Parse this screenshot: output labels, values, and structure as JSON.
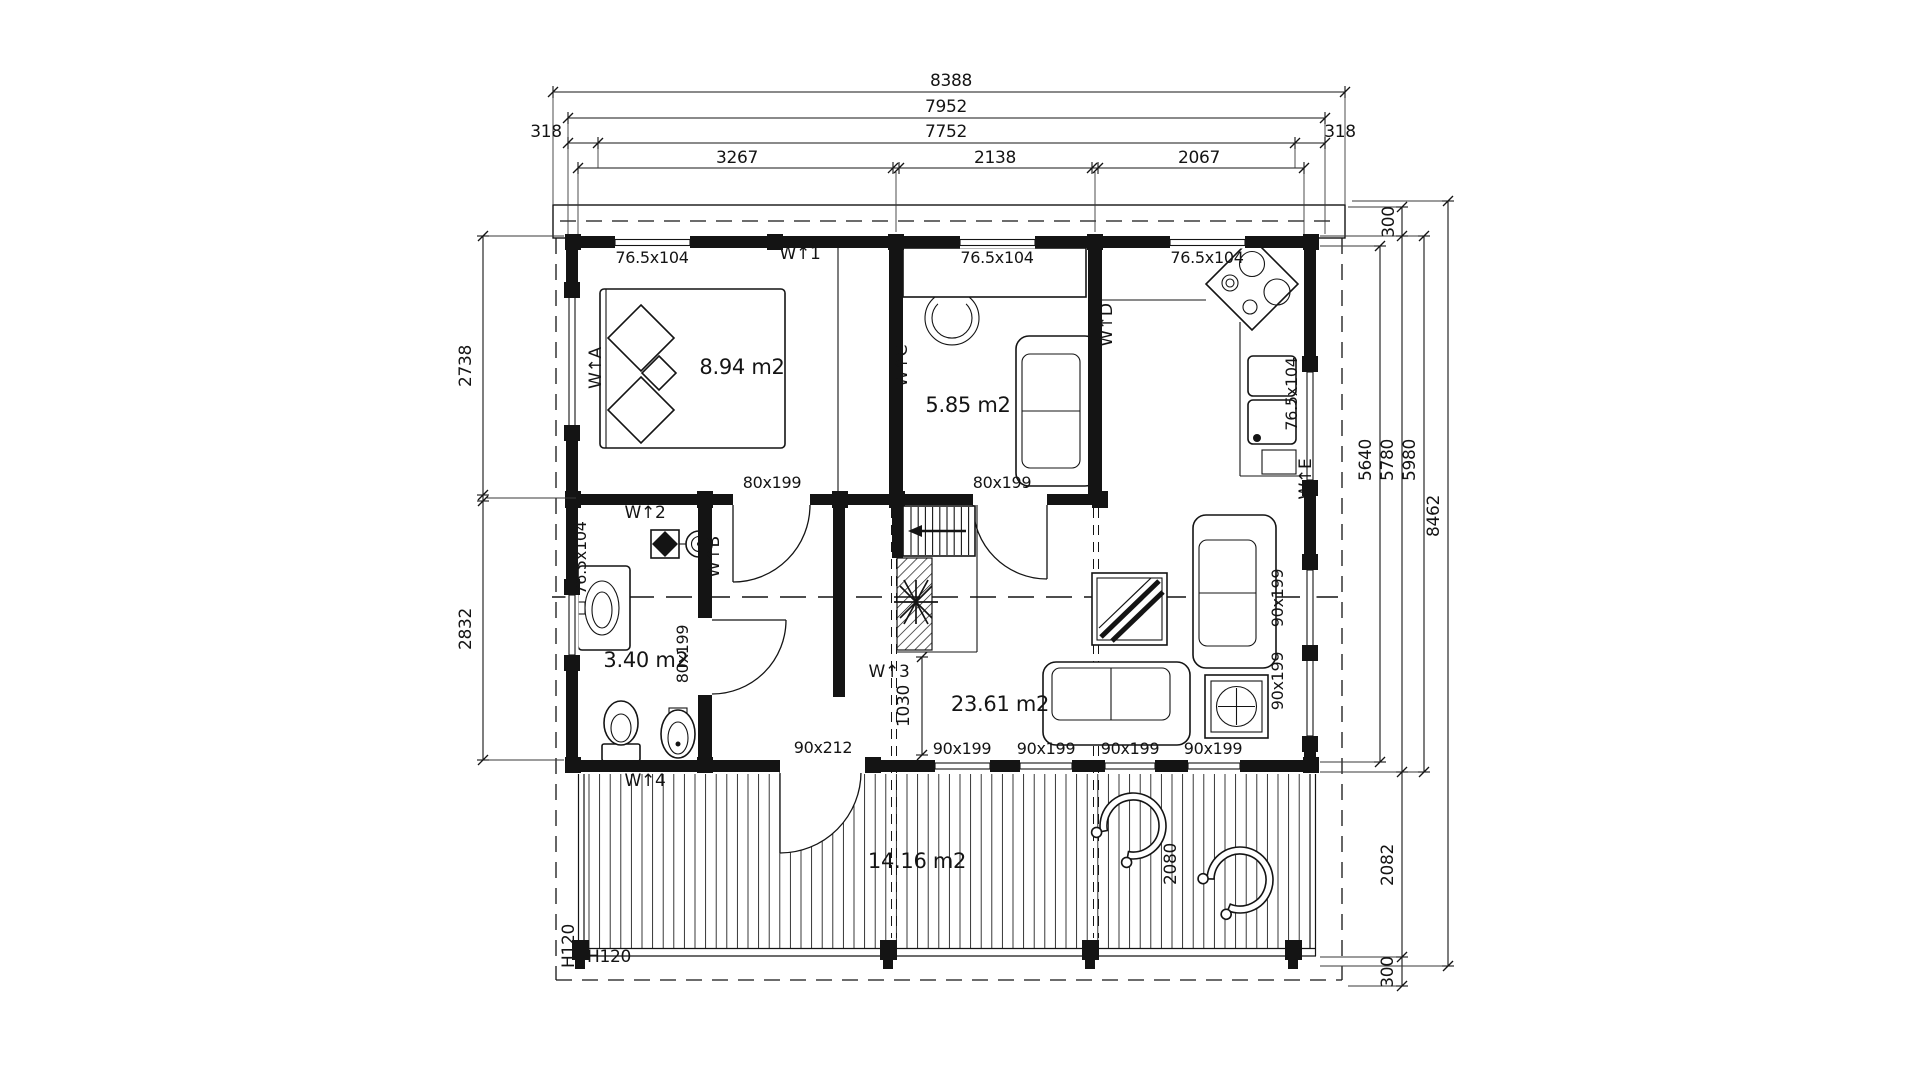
{
  "page": {
    "background": "#ffffff",
    "ink": "#141414"
  },
  "dims_top": {
    "d8388": "8388",
    "d7952": "7952",
    "d7752": "7752",
    "d318_left": "318",
    "d318_right": "318",
    "d3267": "3267",
    "d2138": "2138",
    "d2067": "2067"
  },
  "dims_left": {
    "d2738": "2738",
    "d2832": "2832"
  },
  "dims_right": {
    "d300_top": "300",
    "d5640": "5640",
    "d5780": "5780",
    "d5980": "5980",
    "d8462": "8462",
    "d2082": "2082",
    "d300_bottom": "300"
  },
  "dims_inner": {
    "d1030": "1030",
    "d2080": "2080",
    "h120_left": "H120",
    "h120_bottom": "H120"
  },
  "openings": {
    "small_window": "76.5x104",
    "interior_door": "80x199",
    "terrace_window": "90x199",
    "terrace_door": "90x212"
  },
  "rooms": {
    "bedroom": "8.94 m2",
    "study": "5.85 m2",
    "bathroom": "3.40 m2",
    "living_room": "23.61 m2",
    "terrace": "14.16 m2"
  },
  "markers": {
    "w1": "W↑1",
    "w2": "W↑2",
    "w3": "W↑3",
    "w4": "W↑4",
    "wa": "W↑A",
    "wb": "W↑B",
    "wc": "W↑C",
    "wd": "W↑D",
    "we": "W↑E"
  }
}
